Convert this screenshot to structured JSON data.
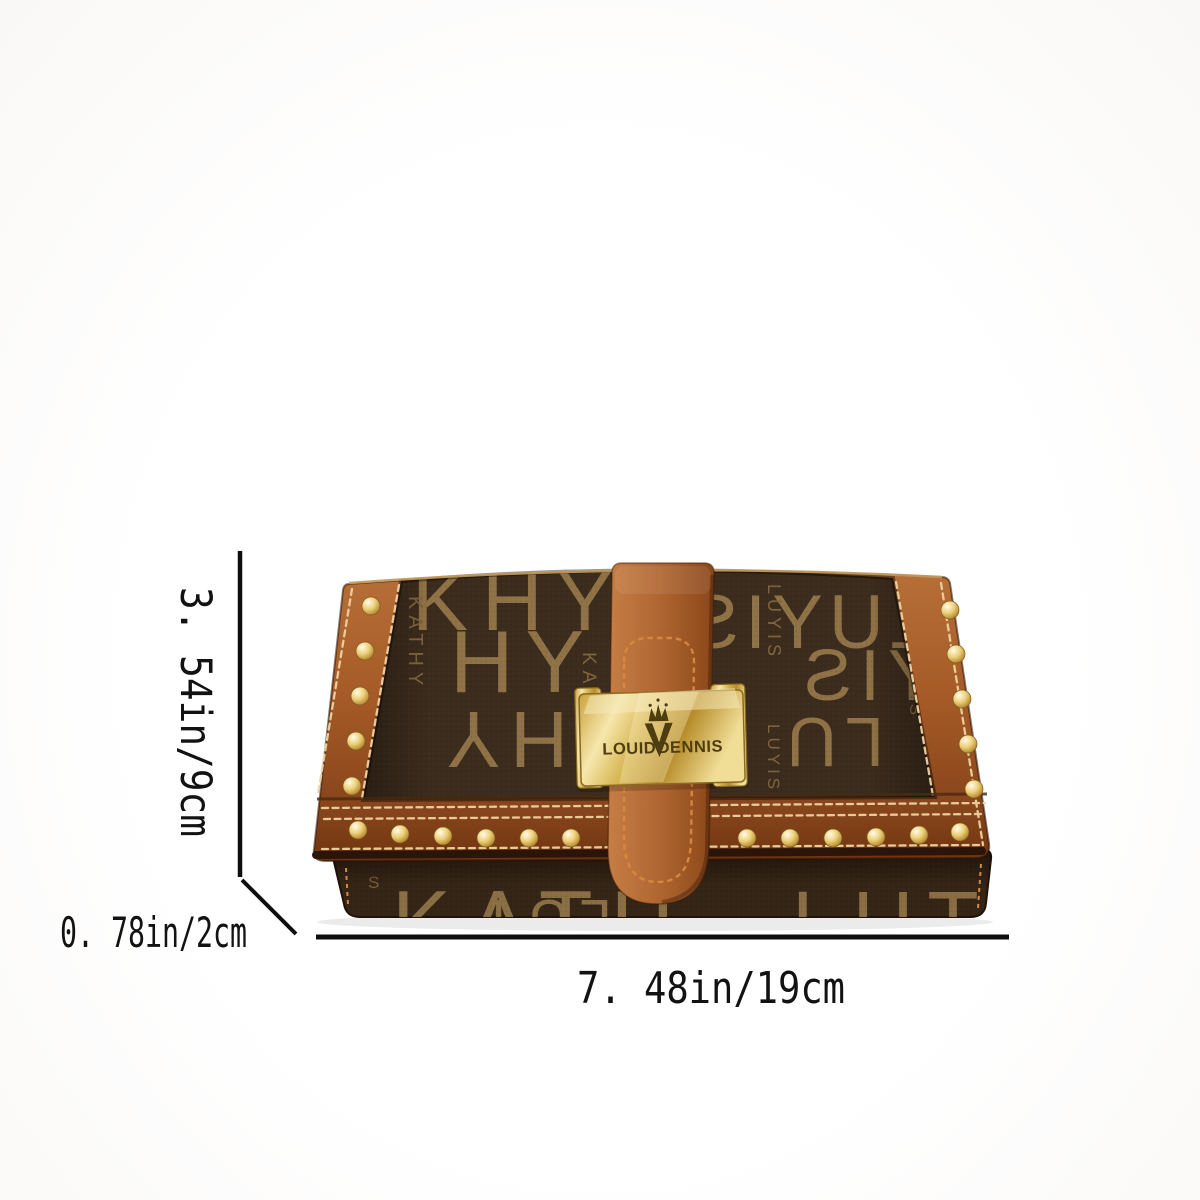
{
  "image_type": "product-dimension-photo",
  "background_color": "#fdfdfd",
  "dimensions": {
    "height_label": "3. 54in/9cm",
    "depth_label": "0. 78in/2cm",
    "width_label": "7. 48in/19cm",
    "line_color": "#0e0e0e"
  },
  "product": {
    "kind": "monogram trifold wallet",
    "brand_plate": {
      "left_word": "LOUID",
      "right_word": "DENNIS",
      "logo": "crown-v-logo",
      "plate_color": "#d9b958",
      "engraving_color": "#4f3d12"
    },
    "monogram": {
      "words": [
        "KATHY",
        "LUYIS"
      ],
      "fragments": {
        "f_top_left": "KHY",
        "f_kathy_1": "KATHY",
        "f_hy": "HY",
        "f_kathy_2": "KATHY",
        "f_hy_inv": "HY",
        "f_luyis_big": "LUYIS",
        "f_luyis_s1": "LUYIS",
        "f_yis_big": "YIS",
        "f_luyis_s2": "LUYIS",
        "f_lu_inv": "LU",
        "f_luyis_s3": "LUYIS",
        "f_under_left": "KATH",
        "f_under_mid": "LUY",
        "f_under_s": "S",
        "f_under_right": "LUT"
      }
    },
    "colors": {
      "canvas": "#3c2c1d",
      "canvas_under": "#342517",
      "monogram_letter_large": "#9a7b4c",
      "monogram_letter_small": "#8a6c42",
      "leather": "#a55a26",
      "leather_dark": "#84431a",
      "stitch": "#eed2a2",
      "strap_stitch": "#d8893f",
      "stud_gold": "#ecd07c",
      "plate_gold": "#d9b958"
    }
  }
}
